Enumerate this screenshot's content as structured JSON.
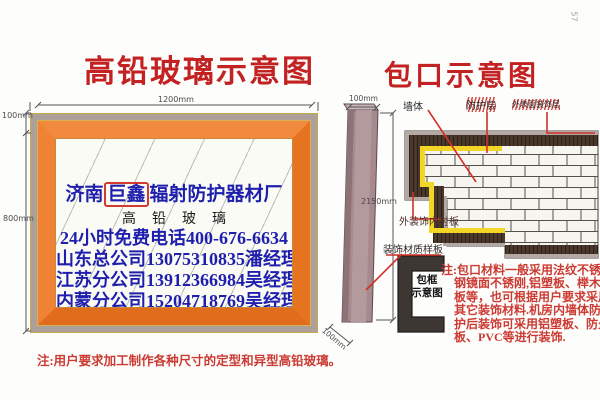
{
  "page": {
    "page_number": "57"
  },
  "left_diagram": {
    "title": "高铅玻璃示意图",
    "dim_top": "1200mm",
    "dim_left_upper": "100mm",
    "dim_left_lower": "800mm",
    "glass": {
      "company_prefix": "济南",
      "company_boxed": "巨鑫",
      "company_suffix": "辐射防护器材厂",
      "product": "高铅玻璃",
      "hotline": "24小时免费电话400-676-6634",
      "contact_shandong": "山东总公司13075310835潘经理",
      "contact_jiangsu": "江苏分公司13912366984吴经理",
      "contact_neimeng": "内蒙分公司15204718769吴经理"
    },
    "note": "注:用户要求加工制作各种尺寸的定型和异型高铅玻璃。"
  },
  "right_diagram": {
    "title": "包口示意图",
    "labels": {
      "wall": "墙体",
      "protective_layer": "防护层",
      "outer_decor_layer": "外表面装饰层",
      "inner_lining": "外装饰内衬板",
      "material_sample": "装饰材质样板",
      "frame_caption_line1": "包框",
      "frame_caption_line2": "示意图"
    },
    "dims": {
      "profile_top": "100mm",
      "profile_height": "2150mm",
      "profile_bottom": "100mm"
    },
    "note": "注:包口材料一般采用法纹不锈钢镜面不锈刚,铝塑板、榉木板等，也可根据用户要求采用其它装饰材料.机房内墙体防护后装饰可采用铝塑板、防火板、PVC等进行装饰."
  },
  "colors": {
    "title_red": "#c32222",
    "text_blue": "#1f1fae",
    "note_red": "#cc3b33",
    "frame_orange": "#ee7f2f",
    "frame_gray": "#ada09b",
    "gold_trim": "#c9a84c",
    "protective_dark": "#4a382c",
    "lining_yellow": "#f2d525",
    "outer_gray": "#b3a8a3",
    "brick_white": "#f7f5f0",
    "profile_mauve": "#a68a8e"
  }
}
